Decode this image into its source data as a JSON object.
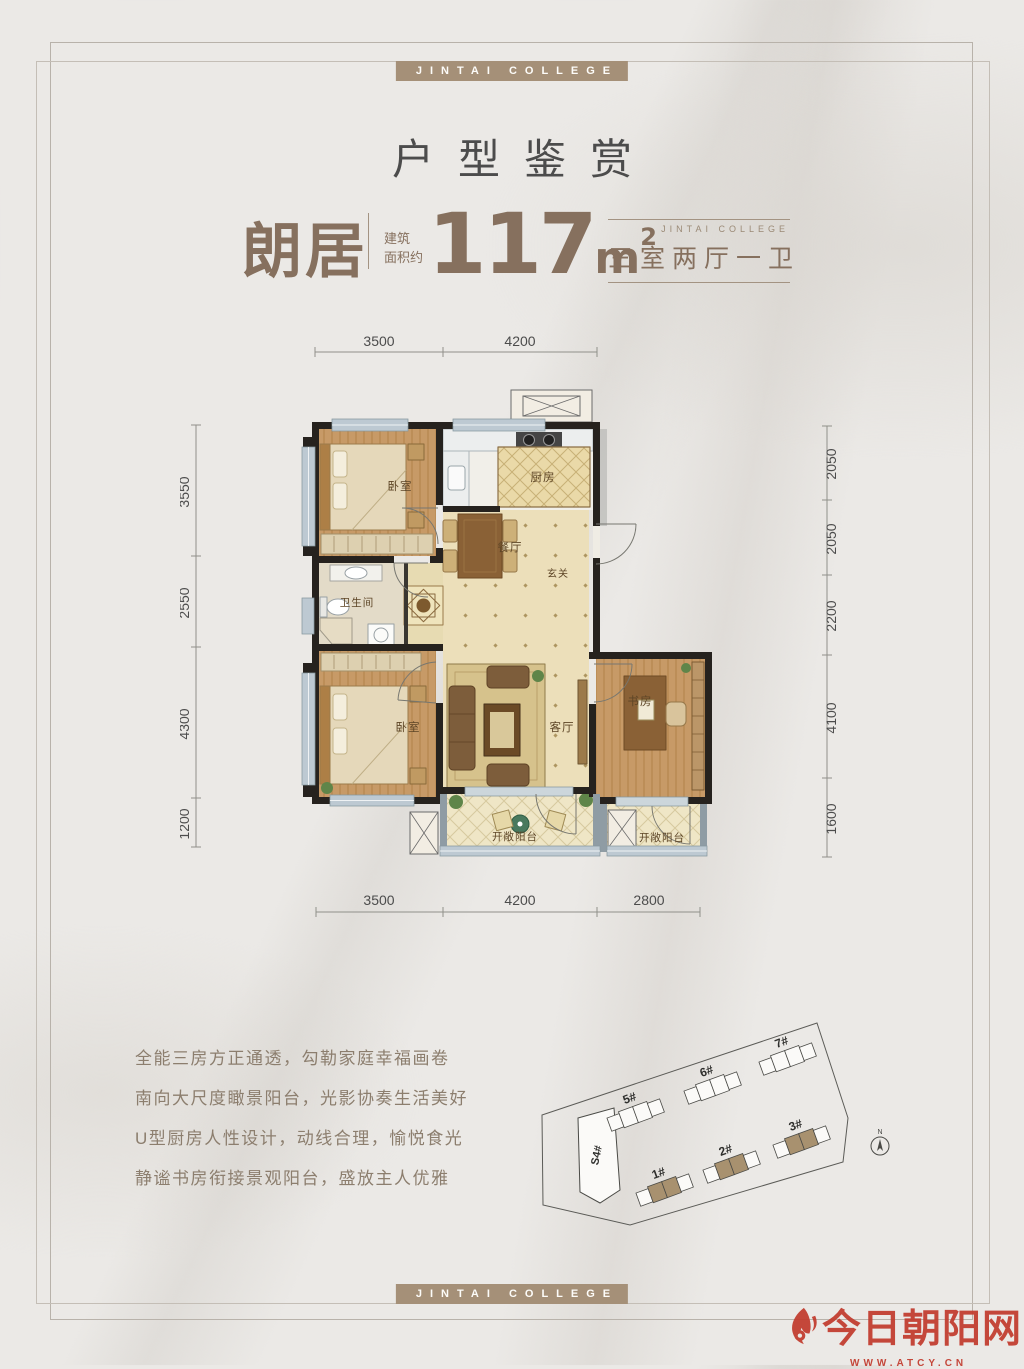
{
  "banners": {
    "top": "JINTAI COLLEGE",
    "bottom": "JINTAI COLLEGE"
  },
  "title": "户型鉴赏",
  "unit_info": {
    "name": "朗居",
    "area_prefix_1": "建筑",
    "area_prefix_2": "面积约",
    "area_value": "117",
    "area_unit": "m",
    "area_exp": "2",
    "brand": "JINTAI COLLEGE",
    "layout": "三室两厅一卫"
  },
  "floorplan": {
    "rooms": {
      "bedroom1": "卧室",
      "kitchen": "厨房",
      "dining": "餐厅",
      "entry": "玄关",
      "bathroom": "卫生间",
      "bedroom2": "卧室",
      "living": "客厅",
      "study": "书房",
      "balcony1": "开敞阳台",
      "balcony2": "开敞阳台"
    },
    "dims": {
      "top": [
        "3500",
        "4200"
      ],
      "bottom": [
        "3500",
        "4200",
        "2800"
      ],
      "left": [
        "3550",
        "2550",
        "4300",
        "1200"
      ],
      "right": [
        "2050",
        "2050",
        "2200",
        "4100",
        "1600"
      ]
    }
  },
  "description": [
    "全能三房方正通透，勾勒家庭幸福画卷",
    "南向大尺度瞰景阳台，光影协奏生活美好",
    "U型厨房人性设计，动线合理，愉悦食光",
    "静谧书房衔接景观阳台，盛放主人优雅"
  ],
  "siteplan": {
    "buildings": [
      "5#",
      "6#",
      "7#",
      "S4#",
      "1#",
      "2#",
      "3#"
    ],
    "compass": "N"
  },
  "logo": {
    "name": "今日朝阳网",
    "url": "WWW.ATCY.CN"
  },
  "colors": {
    "accent": "#86705e",
    "bar": "#a59078",
    "logo_red": "#c23b2e",
    "wall": "#26221e"
  }
}
